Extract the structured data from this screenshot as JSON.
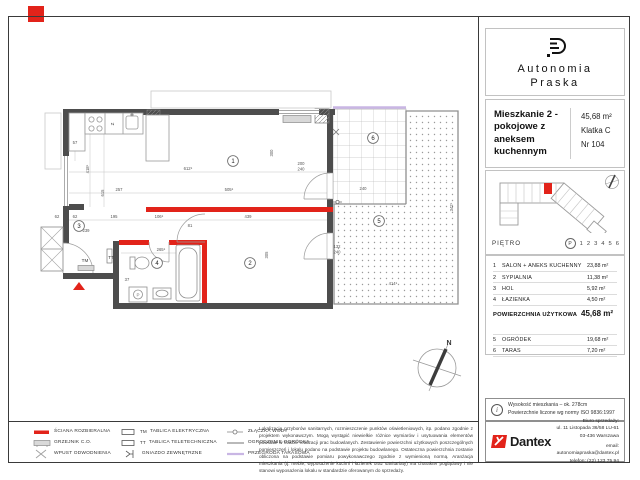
{
  "brand": {
    "line1": "Autonomia",
    "line2": "Praska"
  },
  "header": {
    "title": "Mieszkanie 2 - pokojowe z aneksem kuchennym",
    "area": "45,68 m²",
    "staircase": "Klatka C",
    "number": "Nr 104"
  },
  "minimap": {
    "floor_label": "PIĘTRO",
    "floor_marker": "P",
    "floor_numbers": [
      "1",
      "2",
      "3",
      "4",
      "5",
      "6"
    ]
  },
  "rooms": {
    "rows": [
      {
        "no": "1",
        "name": "SALON + ANEKS KUCHENNY",
        "area": "23,88 m²"
      },
      {
        "no": "2",
        "name": "SYPIALNIA",
        "area": "11,38 m²"
      },
      {
        "no": "3",
        "name": "HOL",
        "area": "5,92 m²"
      },
      {
        "no": "4",
        "name": "ŁAZIENKA",
        "area": "4,50 m²"
      }
    ],
    "total_label": "POWIERZCHNIA UŻYTKOWA",
    "total_area": "45,68 m²",
    "outdoor_rows": [
      {
        "no": "5",
        "name": "OGRÓDEK",
        "area": "19,68 m²"
      },
      {
        "no": "6",
        "name": "TARAS",
        "area": "7,20 m²"
      }
    ]
  },
  "note": {
    "line1": "Wysokość mieszkania – ok. 278cm",
    "line2": "Powierzchnie liczone wg normy ISO 9836:1997"
  },
  "vendor": {
    "name": "Dantex",
    "office_label": "Biuro sprzedaży:",
    "address1": "ul. 11 Listopada 36/58 LU-61",
    "address2": "03-436 Warszawa",
    "email": "email: autonomiapraska@dantex.pl",
    "phone": "telefon: (22) 123 75 94"
  },
  "legend": {
    "items": [
      {
        "icon": "wall-red",
        "label": "ŚCIANA ROZBIERALNA"
      },
      {
        "icon": "radiator",
        "label": "GRZEJNIK C.O."
      },
      {
        "icon": "drain",
        "label": "WPUST ODWODNIENIA"
      },
      {
        "icon": "board",
        "sym": "TM",
        "label": "TABLICA ELEKTRYCZNA"
      },
      {
        "icon": "board",
        "sym": "TT",
        "label": "TABLICA TELETECHNICZNA"
      },
      {
        "icon": "socket",
        "label": "GNIAZDO ZEWNĘTRZNE"
      },
      {
        "icon": "water",
        "label": "ZŁĄCZKA WODY"
      },
      {
        "icon": "fence",
        "label": "OGRODZENIE OGRÓDKA"
      },
      {
        "icon": "partition",
        "label": "PRZEGRODA TARASOWA"
      }
    ]
  },
  "disclaimer": {
    "text": "Lokalizację przyborów sanitarnych, rozmieszczenie punktów oświetleniowych, itp. podano zgodnie z projektem wykonawczym. Mogą wystąpić niewielkie różnice wymiarów i usytuowania elementów powstałe w trakcie realizacji prac budowlanych. Zestawienie powierzchni użytkowych poszczególnych pomieszczeń i lokalu podano na podstawie projektu budowlanego. Ostateczna powierzchnia zostanie obliczona na podstawie pomiaru powykonawczego zgodnie z wymienioną normą. Aranżacja mieszkania (tj. meble, wyposażenie kuchni i łazienek oraz sanitariaty) ma charakter poglądowy i nie stanowi wyposażenia lokalu w standardzie oferowanym do sprzedaży."
  },
  "plan": {
    "room_markers": [
      {
        "n": "1",
        "x": 232,
        "y": 160
      },
      {
        "n": "2",
        "x": 249,
        "y": 262
      },
      {
        "n": "3",
        "x": 78,
        "y": 225
      },
      {
        "n": "4",
        "x": 156,
        "y": 262
      },
      {
        "n": "5",
        "x": 378,
        "y": 220
      },
      {
        "n": "6",
        "x": 372,
        "y": 137
      }
    ],
    "dimensions": [
      {
        "t": "612⁵",
        "x": 187,
        "y": 169
      },
      {
        "t": "257",
        "x": 118,
        "y": 190
      },
      {
        "t": "505⁵",
        "x": 228,
        "y": 190
      },
      {
        "t": "57",
        "x": 74,
        "y": 143
      },
      {
        "t": "62",
        "x": 56,
        "y": 217
      },
      {
        "t": "62",
        "x": 74,
        "y": 217
      },
      {
        "t": "195",
        "x": 113,
        "y": 217
      },
      {
        "t": "106⁵",
        "x": 158,
        "y": 217
      },
      {
        "t": "81",
        "x": 189,
        "y": 226
      },
      {
        "t": "439",
        "x": 247,
        "y": 217
      },
      {
        "t": "239",
        "x": 85,
        "y": 231
      },
      {
        "t": "265⁵",
        "x": 160,
        "y": 250
      },
      {
        "t": "37",
        "x": 126,
        "y": 280
      },
      {
        "t": "418⁵",
        "x": 88,
        "y": 168,
        "r": -90
      },
      {
        "t": "615",
        "x": 103,
        "y": 192,
        "r": -90
      },
      {
        "t": "300",
        "x": 272,
        "y": 152,
        "r": -90
      },
      {
        "t": "305",
        "x": 267,
        "y": 254,
        "r": -90
      },
      {
        "t": "240",
        "x": 362,
        "y": 189
      },
      {
        "t": "200",
        "x": 300,
        "y": 164
      },
      {
        "t": "240",
        "x": 300,
        "y": 169.5
      },
      {
        "t": "132",
        "x": 336,
        "y": 247
      },
      {
        "t": "240",
        "x": 336,
        "y": 252.5
      },
      {
        "t": "414⁵",
        "x": 392,
        "y": 284
      },
      {
        "t": "342⁵",
        "x": 452,
        "y": 206,
        "r": -90
      }
    ],
    "fixture_labels": [
      {
        "t": "TM",
        "x": 84,
        "y": 261
      },
      {
        "t": "TT",
        "x": 110,
        "y": 258
      },
      {
        "t": "Z",
        "x": 113,
        "y": 123,
        "r": -90
      },
      {
        "t": "N",
        "x": 448,
        "y": 344,
        "s": 7,
        "b": 1
      }
    ]
  },
  "colors": {
    "accent_red": "#e2231a",
    "wall": "#4d4d4d",
    "partition_purple": "#c9b6e4"
  }
}
